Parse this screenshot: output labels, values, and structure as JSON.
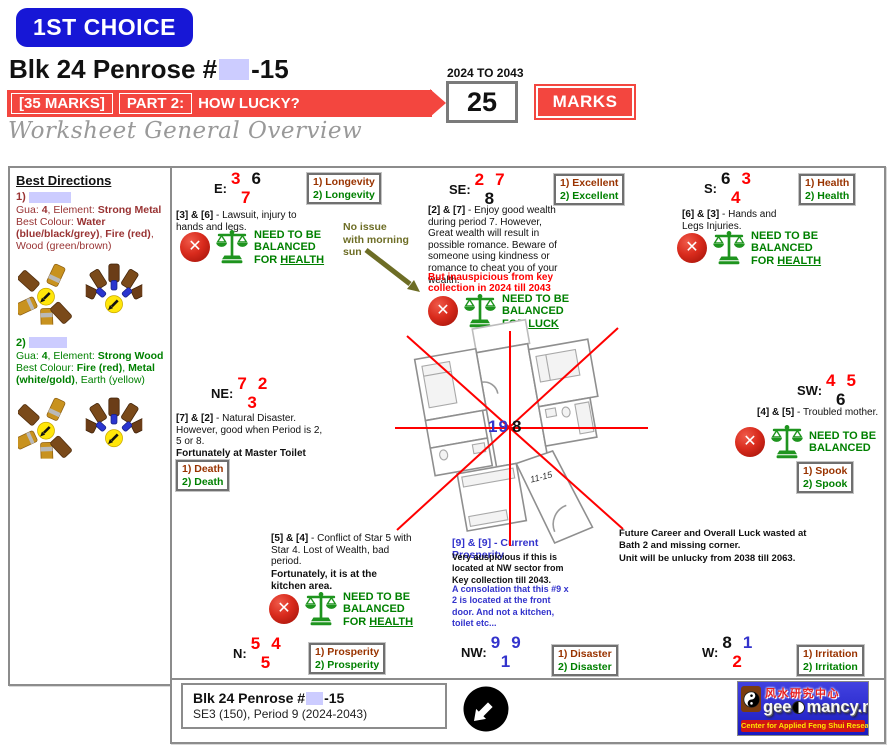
{
  "palette": {
    "accent_blue": "#1717d6",
    "banner_red": "#f3463f",
    "tag_maroon": "#993300",
    "tag_green": "#008000",
    "number_red": "#ff0000",
    "number_blue": "#3333cc",
    "olive_note": "#6d6d25",
    "redaction_lavender": "#ccccff",
    "logo_blue": "#2424c8",
    "scale_green": "#1e941e"
  },
  "header": {
    "choice_badge": "1ST CHOICE",
    "title_prefix": "Blk 24 Penrose #",
    "title_suffix": "-15",
    "marks_bracket": "[35 MARKS]",
    "part_label": "PART 2:",
    "part_question": "HOW LUCKY?",
    "period_range": "2024 TO 2043",
    "score": "25",
    "marks_button": "MARKS",
    "subtitle": "Worksheet General Overview"
  },
  "sidebar": {
    "heading": "Best Directions",
    "entries": [
      {
        "index": "1)",
        "gua_line": [
          {
            "t": "Gua: "
          },
          {
            "t": "4",
            "c": "b"
          },
          {
            "t": ", Element: "
          },
          {
            "t": "Strong Metal",
            "c": "b"
          }
        ],
        "colour_line": [
          {
            "t": "Best Colour: "
          },
          {
            "t": "Water (blue/black/grey)",
            "c": "b"
          },
          {
            "t": ", "
          },
          {
            "t": "Fire (red)",
            "c": "b"
          },
          {
            "t": ", Wood (green/brown)"
          }
        ]
      },
      {
        "index": "2)",
        "gua_line": [
          {
            "t": "Gua: "
          },
          {
            "t": "4",
            "c": "b"
          },
          {
            "t": ", Element: "
          },
          {
            "t": "Strong Wood",
            "c": "b"
          }
        ],
        "colour_line": [
          {
            "t": "Best Colour: "
          },
          {
            "t": "Fire (red)",
            "c": "b"
          },
          {
            "t": ", "
          },
          {
            "t": "Metal (white/gold)",
            "c": "b"
          },
          {
            "t": ", Earth (yellow)"
          }
        ]
      }
    ]
  },
  "directions": {
    "e": {
      "label": "E:",
      "n1": "3",
      "n2": "6",
      "n3": "7"
    },
    "se": {
      "label": "SE:",
      "n1": "2",
      "n2": "7",
      "n3": "8"
    },
    "s": {
      "label": "S:",
      "n1": "6",
      "n2": "3",
      "n3": "4"
    },
    "ne": {
      "label": "NE:",
      "n1": "7",
      "n2": "2",
      "n3": "3"
    },
    "sw": {
      "label": "SW:",
      "n1": "4",
      "n2": "5",
      "n3": "6"
    },
    "n": {
      "label": "N:",
      "n1": "5",
      "n2": "4",
      "n3": "5"
    },
    "nw": {
      "label": "NW:",
      "n1": "9",
      "n2": "9",
      "n3": "1"
    },
    "w": {
      "label": "W:",
      "n1": "8",
      "n2": "1",
      "n3": "2"
    }
  },
  "tags": {
    "e": {
      "l1": "1) Longevity",
      "l2": "2) Longevity"
    },
    "se": {
      "l1": "1) Excellent",
      "l2": "2) Excellent"
    },
    "s": {
      "l1": "1) Health",
      "l2": "2) Health"
    },
    "ne": {
      "l1": "1) Death",
      "l2": "2) Death"
    },
    "sw": {
      "l1": "1) Spook",
      "l2": "2) Spook"
    },
    "n": {
      "l1": "1) Prosperity",
      "l2": "2) Prosperity"
    },
    "nw": {
      "l1": "1) Disaster",
      "l2": "2) Disaster"
    },
    "w": {
      "l1": "1) Irritation",
      "l2": "2) Irritation"
    }
  },
  "notes": {
    "e": [
      {
        "t": "[3] & [6]",
        "c": "b"
      },
      {
        "t": " - Lawsuit, injury to hands and legs."
      }
    ],
    "morning_sun": "No issue\nwith morning\nsun",
    "se": [
      {
        "t": "[2] & [7]",
        "c": "b"
      },
      {
        "t": " - Enjoy good wealth during period 7. However, Great wealth will result in possible romance. Beware of someone using kindness or romance to cheat you of your wealth."
      }
    ],
    "se_warn": "But inauspicious from key collection in 2024 till 2043",
    "s": [
      {
        "t": "[6] & [3]",
        "c": "b"
      },
      {
        "t": " - Hands and Legs Injuries."
      }
    ],
    "ne": [
      {
        "t": "[7] & [2]",
        "c": "b"
      },
      {
        "t": " - Natural Disaster. However, good when Period is 2, 5 or 8."
      }
    ],
    "ne_fort": "Fortunately at Master Toilet",
    "sw": [
      {
        "t": "[4] & [5]",
        "c": "b"
      },
      {
        "t": " - Troubled mother."
      }
    ],
    "kitchen": [
      {
        "t": "[5] & [4]",
        "c": "b"
      },
      {
        "t": " - Conflict of Star 5 with Star 4. Lost of Wealth, bad period."
      }
    ],
    "kitchen_fort": "Fortunately, it is at the kitchen area.",
    "prosperity_title": "[9] & [9] - Current Prosperity",
    "prosperity_body": "Very auspicious if this is located at NW sector from Key collection till 2043.",
    "prosperity_extra": "A consolation that this #9 x 2 is located at the front door. And not a kitchen, toilet etc...",
    "future_1": "Future Career and Overall Luck wasted at Bath 2 and missing corner.",
    "future_2": "Unit will be unlucky from 2038 till 2063."
  },
  "balance": {
    "e": [
      {
        "t": "NEED TO BE\nBALANCED\nFOR "
      },
      {
        "t": "HEALTH",
        "c": "u"
      }
    ],
    "se": [
      {
        "t": "NEED TO BE\nBALANCED\nFOR "
      },
      {
        "t": "LUCK",
        "c": "u"
      }
    ],
    "s": [
      {
        "t": "NEED TO BE\nBALANCED\nFOR "
      },
      {
        "t": "HEALTH",
        "c": "u"
      }
    ],
    "sw": [
      {
        "t": "NEED TO BE\nBALANCED"
      }
    ],
    "kitchen": [
      {
        "t": "NEED TO BE\nBALANCED\nFOR "
      },
      {
        "t": "HEALTH",
        "c": "u"
      }
    ]
  },
  "plan": {
    "center_nums": [
      {
        "t": "1",
        "c": "nb"
      },
      {
        "t": "9",
        "c": "nb"
      },
      {
        "t": "8",
        "c": "nk sp"
      }
    ],
    "unit_label": "11-15"
  },
  "footer": {
    "address_prefix": "Blk 24 Penrose #",
    "address_suffix": "-15",
    "address_line2": "SE3 (150), Period 9 (2024-2043)"
  },
  "logo": {
    "chinese": "风水研究中心",
    "brand_pre": "gee",
    "brand_post": "mancy.net",
    "tagline": "Center for Applied Feng Shui Research"
  }
}
